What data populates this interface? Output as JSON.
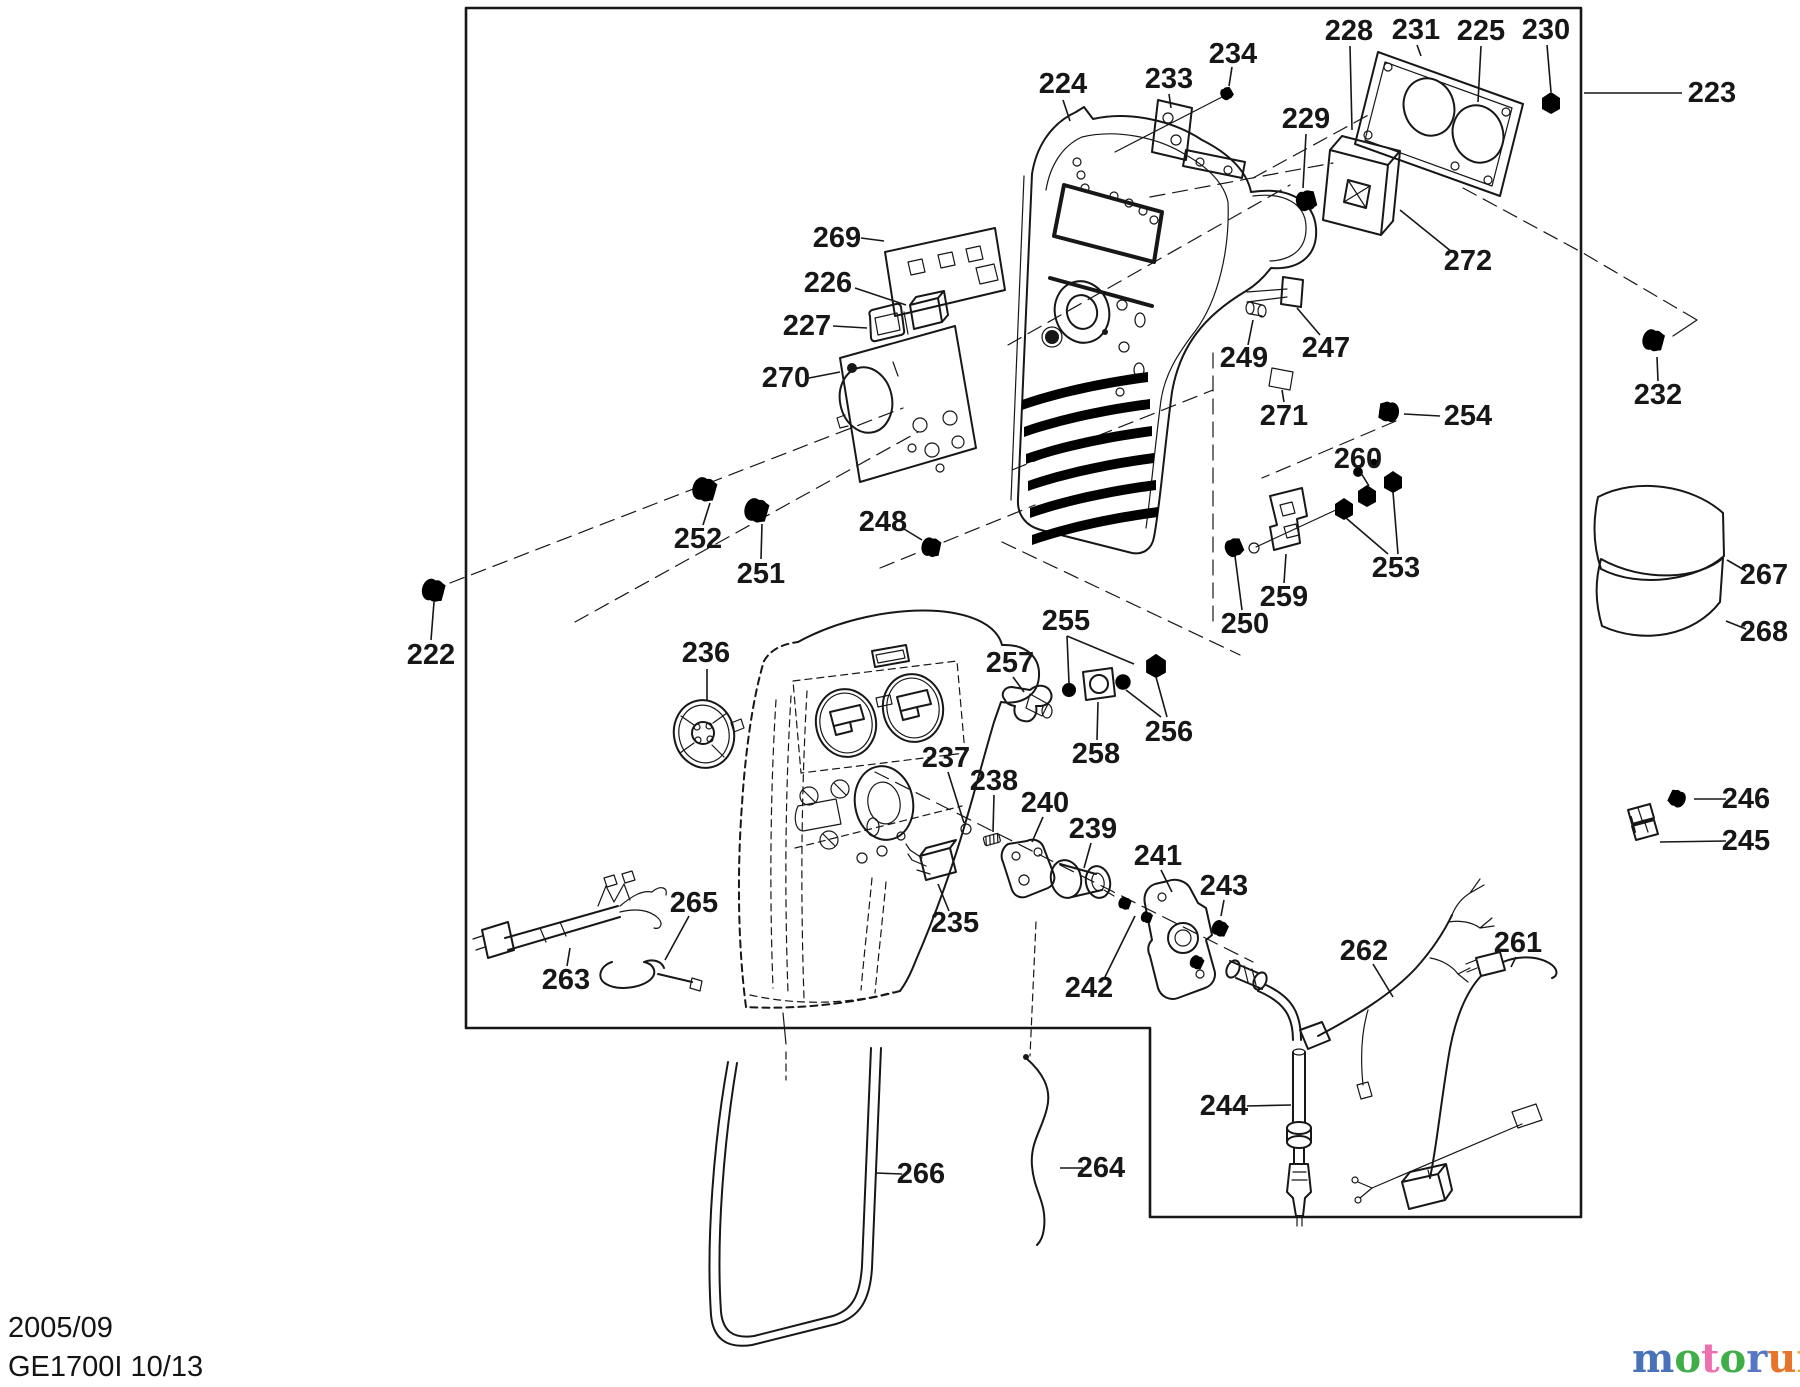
{
  "page": {
    "background": "#ffffff",
    "line_color": "#171717"
  },
  "footer": {
    "date": "2005/09",
    "model": "GE1700I 10/13"
  },
  "logo": {
    "letters": [
      {
        "ch": "m",
        "color": "#4a72b8"
      },
      {
        "ch": "o",
        "color": "#3fae49"
      },
      {
        "ch": "t",
        "color": "#ee6fad"
      },
      {
        "ch": "o",
        "color": "#3fae49"
      },
      {
        "ch": "r",
        "color": "#5577c6"
      },
      {
        "ch": "u",
        "color": "#e8732b"
      },
      {
        "ch": "f",
        "color": "#f2a71e"
      }
    ],
    "tick": "’",
    "tick_color": "#aaaaaa",
    "suffix": ".de",
    "suffix_color": "#666666"
  },
  "parts": [
    {
      "num": "222",
      "x": 431,
      "y": 655,
      "leaders": [
        [
          [
            431,
            640
          ],
          [
            434,
            602
          ]
        ]
      ]
    },
    {
      "num": "223",
      "x": 1712,
      "y": 93,
      "leaders": [
        [
          [
            1682,
            93
          ],
          [
            1584,
            93
          ]
        ]
      ]
    },
    {
      "num": "224",
      "x": 1063,
      "y": 84,
      "leaders": [
        [
          [
            1063,
            100
          ],
          [
            1070,
            121
          ]
        ]
      ]
    },
    {
      "num": "225",
      "x": 1481,
      "y": 31,
      "leaders": [
        [
          [
            1481,
            46
          ],
          [
            1478,
            102
          ]
        ]
      ]
    },
    {
      "num": "226",
      "x": 828,
      "y": 283,
      "leaders": [
        [
          [
            855,
            288
          ],
          [
            906,
            305
          ]
        ]
      ]
    },
    {
      "num": "227",
      "x": 807,
      "y": 326,
      "leaders": [
        [
          [
            833,
            326
          ],
          [
            867,
            328
          ]
        ]
      ]
    },
    {
      "num": "228",
      "x": 1349,
      "y": 31,
      "leaders": [
        [
          [
            1350,
            46
          ],
          [
            1352,
            130
          ]
        ]
      ]
    },
    {
      "num": "229",
      "x": 1306,
      "y": 119,
      "leaders": [
        [
          [
            1306,
            134
          ],
          [
            1303,
            188
          ]
        ]
      ]
    },
    {
      "num": "230",
      "x": 1546,
      "y": 30,
      "leaders": [
        [
          [
            1547,
            45
          ],
          [
            1551,
            92
          ]
        ]
      ]
    },
    {
      "num": "231",
      "x": 1416,
      "y": 30,
      "leaders": [
        [
          [
            1417,
            45
          ],
          [
            1421,
            56
          ]
        ]
      ]
    },
    {
      "num": "232",
      "x": 1658,
      "y": 395,
      "leaders": [
        [
          [
            1658,
            381
          ],
          [
            1657,
            357
          ]
        ]
      ]
    },
    {
      "num": "233",
      "x": 1169,
      "y": 79,
      "leaders": [
        [
          [
            1169,
            94
          ],
          [
            1171,
            108
          ]
        ]
      ]
    },
    {
      "num": "234",
      "x": 1233,
      "y": 54,
      "leaders": [
        [
          [
            1232,
            67
          ],
          [
            1229,
            86
          ]
        ]
      ]
    },
    {
      "num": "235",
      "x": 955,
      "y": 923,
      "leaders": [
        [
          [
            949,
            911
          ],
          [
            938,
            884
          ]
        ]
      ]
    },
    {
      "num": "236",
      "x": 706,
      "y": 653,
      "leaders": [
        [
          [
            707,
            669
          ],
          [
            707,
            701
          ]
        ]
      ]
    },
    {
      "num": "237",
      "x": 946,
      "y": 758,
      "leaders": [
        [
          [
            948,
            772
          ],
          [
            964,
            823
          ]
        ]
      ]
    },
    {
      "num": "238",
      "x": 994,
      "y": 781,
      "leaders": [
        [
          [
            994,
            795
          ],
          [
            993,
            832
          ]
        ]
      ]
    },
    {
      "num": "239",
      "x": 1093,
      "y": 829,
      "leaders": [
        [
          [
            1091,
            843
          ],
          [
            1084,
            868
          ]
        ]
      ]
    },
    {
      "num": "240",
      "x": 1045,
      "y": 803,
      "leaders": [
        [
          [
            1043,
            817
          ],
          [
            1032,
            842
          ]
        ]
      ]
    },
    {
      "num": "241",
      "x": 1158,
      "y": 856,
      "leaders": [
        [
          [
            1161,
            870
          ],
          [
            1172,
            892
          ]
        ]
      ]
    },
    {
      "num": "242",
      "x": 1089,
      "y": 988,
      "leaders": [
        [
          [
            1104,
            979
          ],
          [
            1135,
            916
          ]
        ]
      ]
    },
    {
      "num": "243",
      "x": 1224,
      "y": 886,
      "leaders": [
        [
          [
            1224,
            900
          ],
          [
            1221,
            916
          ]
        ]
      ]
    },
    {
      "num": "244",
      "x": 1224,
      "y": 1106,
      "leaders": [
        [
          [
            1247,
            1106
          ],
          [
            1291,
            1105
          ]
        ]
      ]
    },
    {
      "num": "245",
      "x": 1746,
      "y": 841,
      "leaders": [
        [
          [
            1726,
            841
          ],
          [
            1660,
            842
          ]
        ]
      ]
    },
    {
      "num": "246",
      "x": 1746,
      "y": 799,
      "leaders": [
        [
          [
            1726,
            799
          ],
          [
            1694,
            799
          ]
        ]
      ]
    },
    {
      "num": "247",
      "x": 1326,
      "y": 348,
      "leaders": [
        [
          [
            1320,
            335
          ],
          [
            1297,
            308
          ]
        ]
      ]
    },
    {
      "num": "248",
      "x": 883,
      "y": 522,
      "leaders": [
        [
          [
            904,
            529
          ],
          [
            922,
            540
          ]
        ]
      ]
    },
    {
      "num": "249",
      "x": 1244,
      "y": 358,
      "leaders": [
        [
          [
            1248,
            345
          ],
          [
            1253,
            320
          ]
        ]
      ]
    },
    {
      "num": "250",
      "x": 1245,
      "y": 624,
      "leaders": [
        [
          [
            1242,
            610
          ],
          [
            1235,
            556
          ]
        ]
      ]
    },
    {
      "num": "251",
      "x": 761,
      "y": 574,
      "leaders": [
        [
          [
            761,
            559
          ],
          [
            762,
            524
          ]
        ]
      ]
    },
    {
      "num": "252",
      "x": 698,
      "y": 539,
      "leaders": [
        [
          [
            703,
            525
          ],
          [
            710,
            503
          ]
        ]
      ]
    },
    {
      "num": "253",
      "x": 1396,
      "y": 568,
      "leaders": [
        [
          [
            1388,
            554
          ],
          [
            1346,
            518
          ]
        ],
        [
          [
            1398,
            554
          ],
          [
            1393,
            492
          ]
        ]
      ]
    },
    {
      "num": "254",
      "x": 1468,
      "y": 416,
      "leaders": [
        [
          [
            1440,
            416
          ],
          [
            1404,
            414
          ]
        ]
      ]
    },
    {
      "num": "255",
      "x": 1066,
      "y": 621,
      "leaders": [
        [
          [
            1067,
            636
          ],
          [
            1069,
            683
          ]
        ],
        [
          [
            1067,
            636
          ],
          [
            1134,
            664
          ]
        ]
      ]
    },
    {
      "num": "256",
      "x": 1169,
      "y": 732,
      "leaders": [
        [
          [
            1161,
            717
          ],
          [
            1126,
            690
          ]
        ],
        [
          [
            1167,
            717
          ],
          [
            1156,
            677
          ]
        ]
      ]
    },
    {
      "num": "257",
      "x": 1010,
      "y": 663,
      "leaders": [
        [
          [
            1013,
            677
          ],
          [
            1024,
            692
          ]
        ]
      ]
    },
    {
      "num": "258",
      "x": 1096,
      "y": 754,
      "leaders": [
        [
          [
            1097,
            740
          ],
          [
            1098,
            702
          ]
        ]
      ]
    },
    {
      "num": "259",
      "x": 1284,
      "y": 597,
      "leaders": [
        [
          [
            1284,
            583
          ],
          [
            1286,
            554
          ]
        ]
      ]
    },
    {
      "num": "260",
      "x": 1358,
      "y": 459,
      "leaders": [
        [
          [
            1361,
            473
          ],
          [
            1369,
            486
          ]
        ]
      ]
    },
    {
      "num": "261",
      "x": 1518,
      "y": 943,
      "leaders": [
        [
          [
            1516,
            957
          ],
          [
            1511,
            967
          ]
        ]
      ]
    },
    {
      "num": "262",
      "x": 1364,
      "y": 951,
      "leaders": [
        [
          [
            1373,
            964
          ],
          [
            1393,
            997
          ]
        ]
      ]
    },
    {
      "num": "263",
      "x": 566,
      "y": 980,
      "leaders": [
        [
          [
            567,
            966
          ],
          [
            570,
            948
          ]
        ]
      ]
    },
    {
      "num": "264",
      "x": 1101,
      "y": 1168,
      "leaders": [
        [
          [
            1083,
            1168
          ],
          [
            1060,
            1168
          ]
        ]
      ]
    },
    {
      "num": "265",
      "x": 694,
      "y": 903,
      "leaders": [
        [
          [
            689,
            916
          ],
          [
            665,
            960
          ]
        ]
      ]
    },
    {
      "num": "266",
      "x": 921,
      "y": 1174,
      "leaders": [
        [
          [
            902,
            1174
          ],
          [
            876,
            1173
          ]
        ]
      ]
    },
    {
      "num": "267",
      "x": 1764,
      "y": 575,
      "leaders": [
        [
          [
            1746,
            571
          ],
          [
            1727,
            560
          ]
        ]
      ]
    },
    {
      "num": "268",
      "x": 1764,
      "y": 632,
      "leaders": [
        [
          [
            1746,
            629
          ],
          [
            1726,
            621
          ]
        ]
      ]
    },
    {
      "num": "269",
      "x": 837,
      "y": 238,
      "leaders": [
        [
          [
            861,
            238
          ],
          [
            884,
            241
          ]
        ]
      ]
    },
    {
      "num": "270",
      "x": 786,
      "y": 378,
      "leaders": [
        [
          [
            809,
            378
          ],
          [
            840,
            372
          ]
        ]
      ]
    },
    {
      "num": "271",
      "x": 1284,
      "y": 416,
      "leaders": [
        [
          [
            1284,
            402
          ],
          [
            1282,
            390
          ]
        ]
      ]
    },
    {
      "num": "272",
      "x": 1468,
      "y": 261,
      "leaders": [
        [
          [
            1452,
            252
          ],
          [
            1400,
            210
          ]
        ]
      ]
    }
  ]
}
